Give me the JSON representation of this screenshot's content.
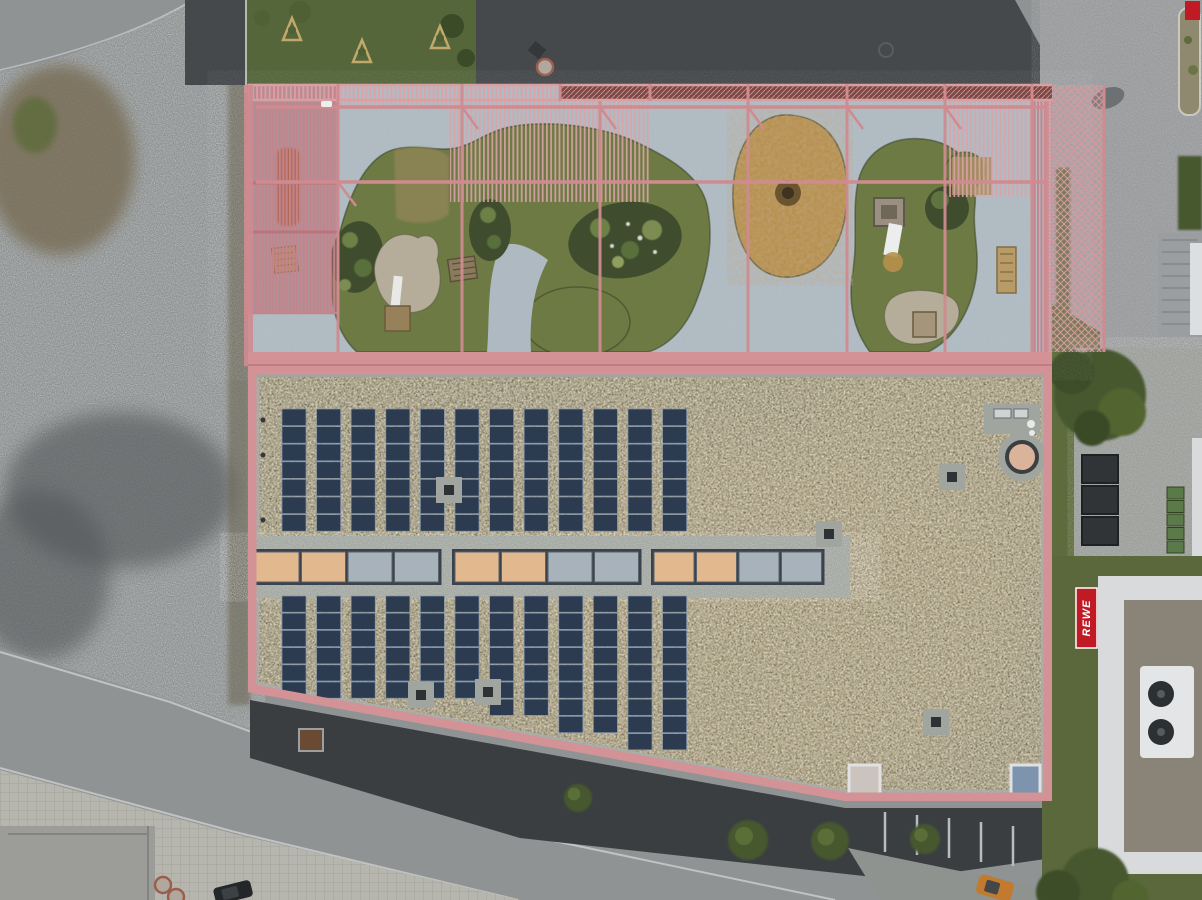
{
  "scene": {
    "type": "aerial-drone-photograph",
    "description": "Top-down drone photo of a kindergarten building: pink-fenced rooftop playground with organic grass islands (upper half) and a brown sedum green roof with photovoltaic rows and a linear skylight band (lower half); gravel lot left, roads below, lawn, bins and a REWE supermarket to the right."
  },
  "palette": {
    "pink": "#cf8b90",
    "pink_light": "#dba3a8",
    "pink_dense": "#c5838b",
    "pink_parapet": "#d29296",
    "play_floor": "#aeb9c1",
    "grass": "#6d7a43",
    "grass_dark": "#39412a",
    "dry_patch": "#8d8354",
    "woodchip": "#b6904d",
    "woodchip_ring": "#6b5530",
    "sand": "#b5ad9a",
    "bed_green": "#3f4d2e",
    "sedum_base": "#56503f",
    "gravel": "#a0a59f",
    "solar_panel": "#2c3b50",
    "solar_frame": "#8494a8",
    "skylight_warm": "#e2b88e",
    "skylight_cool": "#a8b2ba",
    "skylight_frame": "#3b424b",
    "asphalt_dark": "#45494c",
    "road_light": "#8f9394",
    "paver": "#b6b6ae",
    "lawn": "#5a683c",
    "tree": "#47582f",
    "white_building": "#d8dadb",
    "rewe_red": "#c01a25",
    "bin_green": "#5a7a49",
    "container_dark": "#303437",
    "car_dark": "#24272a",
    "car_orange": "#c27a2e",
    "equip_orange": "#b35a24"
  },
  "playground": {
    "surface": "pale blue-gray deck",
    "grass_islands": 3,
    "planting_beds": 3,
    "sand_areas": 2,
    "woodchip_ovals": 1,
    "benches": 2,
    "canopy": "pink steel slat pergola",
    "perimeter": "pink mesh fence"
  },
  "roof": {
    "surface": "brown sedum green roof",
    "solar_upper": {
      "columns": 12,
      "panels_per_column": 7
    },
    "solar_lower": {
      "columns": 12,
      "panels_per_column": [
        6,
        6,
        6,
        6,
        6,
        6,
        7,
        7,
        8,
        8,
        9,
        9
      ]
    },
    "skylights": {
      "groups": 3,
      "panes_per_group": 4,
      "tints": [
        "warm",
        "warm",
        "cool",
        "cool"
      ],
      "group_x": [
        252,
        452,
        651
      ],
      "pane_w": [
        44,
        44,
        40
      ]
    },
    "roof_vents": [
      {
        "x": 449,
        "y": 490
      },
      {
        "x": 952,
        "y": 477
      },
      {
        "x": 829,
        "y": 534
      },
      {
        "x": 421,
        "y": 695
      },
      {
        "x": 936,
        "y": 722
      },
      {
        "x": 488,
        "y": 692
      }
    ],
    "corner_skylights": 2,
    "round_vents": 1
  },
  "surroundings": {
    "store_sign_text": "REWE",
    "waste_containers": 3,
    "green_bins": 5,
    "street_trees": [
      {
        "x": 578,
        "y": 798,
        "r": 14
      },
      {
        "x": 748,
        "y": 840,
        "r": 20
      },
      {
        "x": 830,
        "y": 841,
        "r": 19
      },
      {
        "x": 925,
        "y": 839,
        "r": 15
      }
    ],
    "saplings": [
      {
        "x": 292,
        "y": 30
      },
      {
        "x": 362,
        "y": 52
      },
      {
        "x": 440,
        "y": 38
      }
    ],
    "manholes": [
      {
        "x": 545,
        "y": 67,
        "r": 8
      },
      {
        "x": 163,
        "y": 885,
        "r": 8
      },
      {
        "x": 176,
        "y": 897,
        "r": 8
      }
    ],
    "parked_cars": 2
  }
}
